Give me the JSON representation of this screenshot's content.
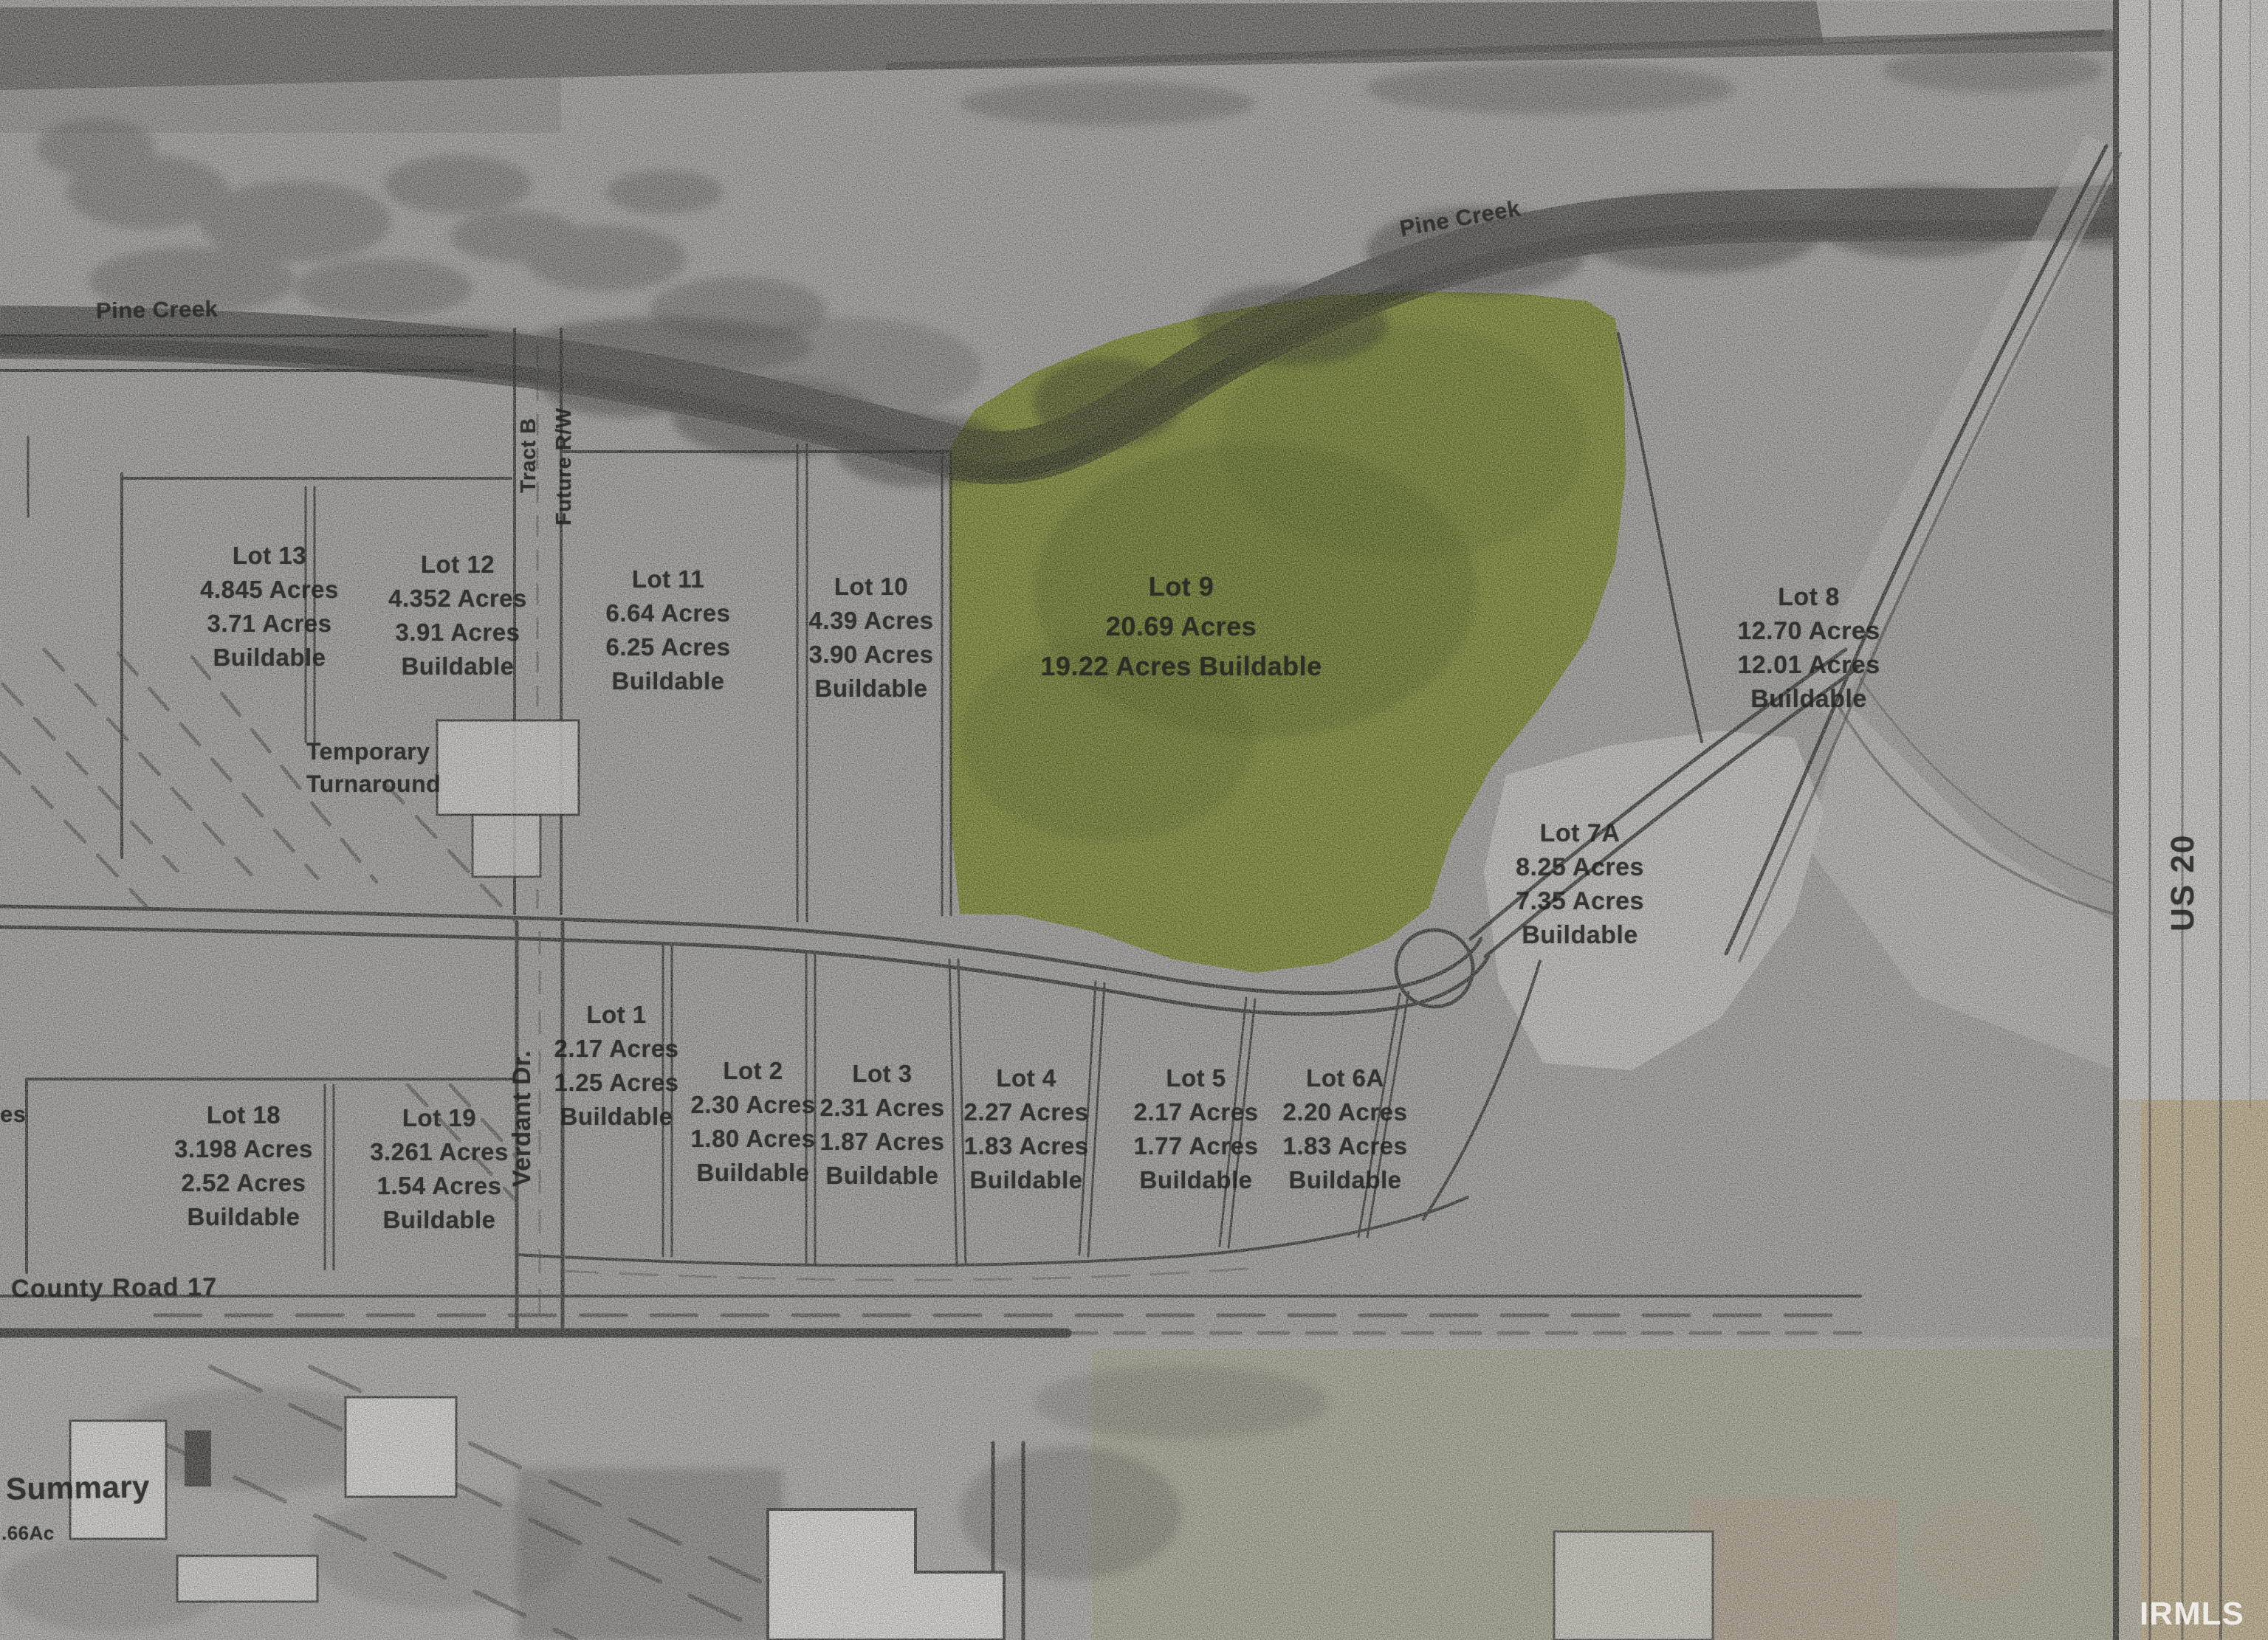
{
  "map": {
    "creek_label_left": "Pine Creek",
    "creek_label_top": "Pine Creek",
    "tract_label": "Tract B",
    "future_rw_label": "Future R/W",
    "turnaround_line1": "Temporary",
    "turnaround_line2": "Turnaround",
    "roads": {
      "verdant": "Verdant Dr.",
      "county": "County Road 17",
      "us20": "US 20"
    },
    "summary_label": "Summary",
    "summary_acres": ".66Ac",
    "edge_fragment": "es",
    "watermark": "IRMLS",
    "highlight_color": "#b5cd24",
    "lots": [
      {
        "name": "Lot 13",
        "lines": [
          "4.845 Acres",
          "3.71 Acres",
          "Buildable"
        ]
      },
      {
        "name": "Lot 12",
        "lines": [
          "4.352 Acres",
          "3.91 Acres",
          "Buildable"
        ]
      },
      {
        "name": "Lot 11",
        "lines": [
          "6.64 Acres",
          "6.25 Acres",
          "Buildable"
        ]
      },
      {
        "name": "Lot 10",
        "lines": [
          "4.39 Acres",
          "3.90 Acres",
          "Buildable"
        ]
      },
      {
        "name": "Lot 9",
        "lines": [
          "20.69 Acres",
          "19.22 Acres Buildable"
        ]
      },
      {
        "name": "Lot 8",
        "lines": [
          "12.70 Acres",
          "12.01 Acres",
          "Buildable"
        ]
      },
      {
        "name": "Lot 7A",
        "lines": [
          "8.25 Acres",
          "7.35 Acres",
          "Buildable"
        ]
      },
      {
        "name": "Lot 1",
        "lines": [
          "2.17 Acres",
          "1.25 Acres",
          "Buildable"
        ]
      },
      {
        "name": "Lot 2",
        "lines": [
          "2.30 Acres",
          "1.80 Acres",
          "Buildable"
        ]
      },
      {
        "name": "Lot 3",
        "lines": [
          "2.31 Acres",
          "1.87 Acres",
          "Buildable"
        ]
      },
      {
        "name": "Lot 4",
        "lines": [
          "2.27 Acres",
          "1.83 Acres",
          "Buildable"
        ]
      },
      {
        "name": "Lot 5",
        "lines": [
          "2.17 Acres",
          "1.77 Acres",
          "Buildable"
        ]
      },
      {
        "name": "Lot 6A",
        "lines": [
          "2.20 Acres",
          "1.83 Acres",
          "Buildable"
        ]
      },
      {
        "name": "Lot 18",
        "lines": [
          "3.198 Acres",
          "2.52 Acres",
          "Buildable"
        ]
      },
      {
        "name": "Lot 19",
        "lines": [
          "3.261 Acres",
          "1.54 Acres",
          "Buildable"
        ]
      }
    ]
  }
}
